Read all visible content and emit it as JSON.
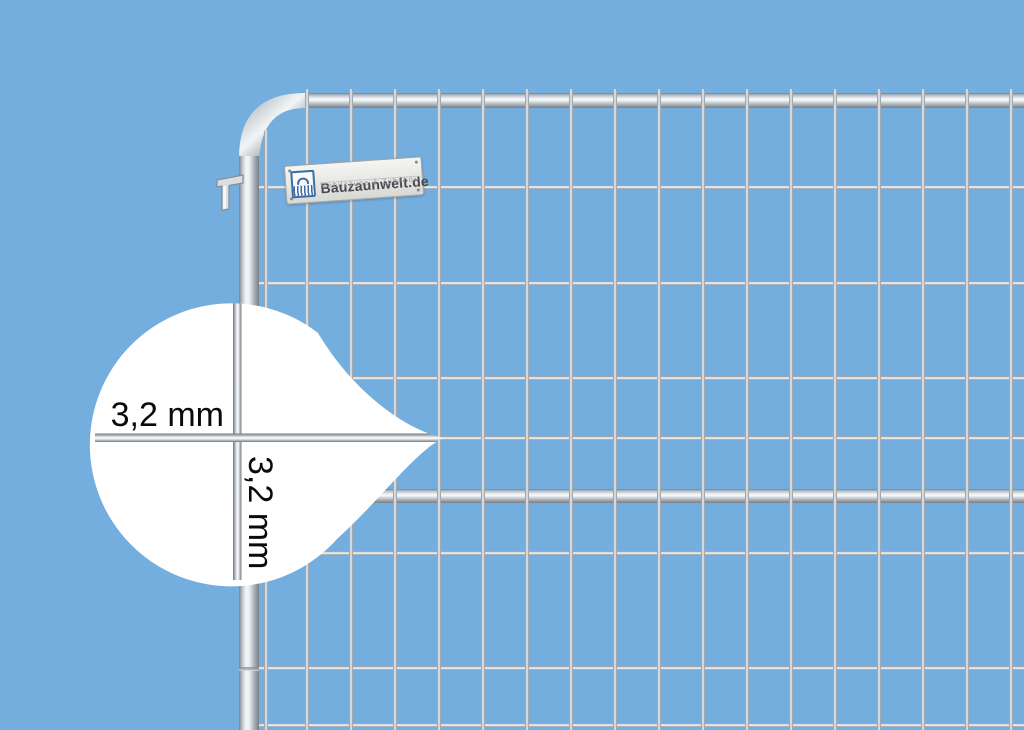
{
  "scene": {
    "description": "Galvanized mobile construction fence panel photographed on a plain blue background with a magnifier callout showing the mesh wire gauge"
  },
  "magnifier": {
    "horizontal_label": "3,2 mm",
    "vertical_label": "3,2 mm"
  },
  "brand_plate": {
    "title": "Bauzaunwelt.de",
    "subtitle": "Mobilzäune & Zubehör",
    "logo": "fence-dome-logo"
  },
  "fence": {
    "rows_y": [
      187,
      283,
      378,
      438,
      553,
      668,
      725
    ],
    "columns": [
      {
        "x": 266,
        "y_top": 130
      },
      {
        "x": 307,
        "y_top": 89
      },
      {
        "x": 351,
        "y_top": 89
      },
      {
        "x": 395,
        "y_top": 89
      },
      {
        "x": 439,
        "y_top": 89
      },
      {
        "x": 483,
        "y_top": 89
      },
      {
        "x": 527,
        "y_top": 89
      },
      {
        "x": 571,
        "y_top": 89
      },
      {
        "x": 615,
        "y_top": 89
      },
      {
        "x": 659,
        "y_top": 89
      },
      {
        "x": 703,
        "y_top": 89
      },
      {
        "x": 747,
        "y_top": 89
      },
      {
        "x": 791,
        "y_top": 89
      },
      {
        "x": 835,
        "y_top": 89
      },
      {
        "x": 879,
        "y_top": 89
      },
      {
        "x": 923,
        "y_top": 89
      },
      {
        "x": 967,
        "y_top": 89
      },
      {
        "x": 1011,
        "y_top": 89
      }
    ],
    "wire_thickness_px": 4
  },
  "colors": {
    "background": "#74aede",
    "wire_light": "#eef1f3",
    "wire_dark": "#868e95",
    "magnifier_fill": "#ffffff",
    "label_text": "#0a0a0a",
    "plate_title": "#45494c",
    "plate_subtitle": "#949a9e",
    "logo_blue": "#3c6ca6"
  }
}
